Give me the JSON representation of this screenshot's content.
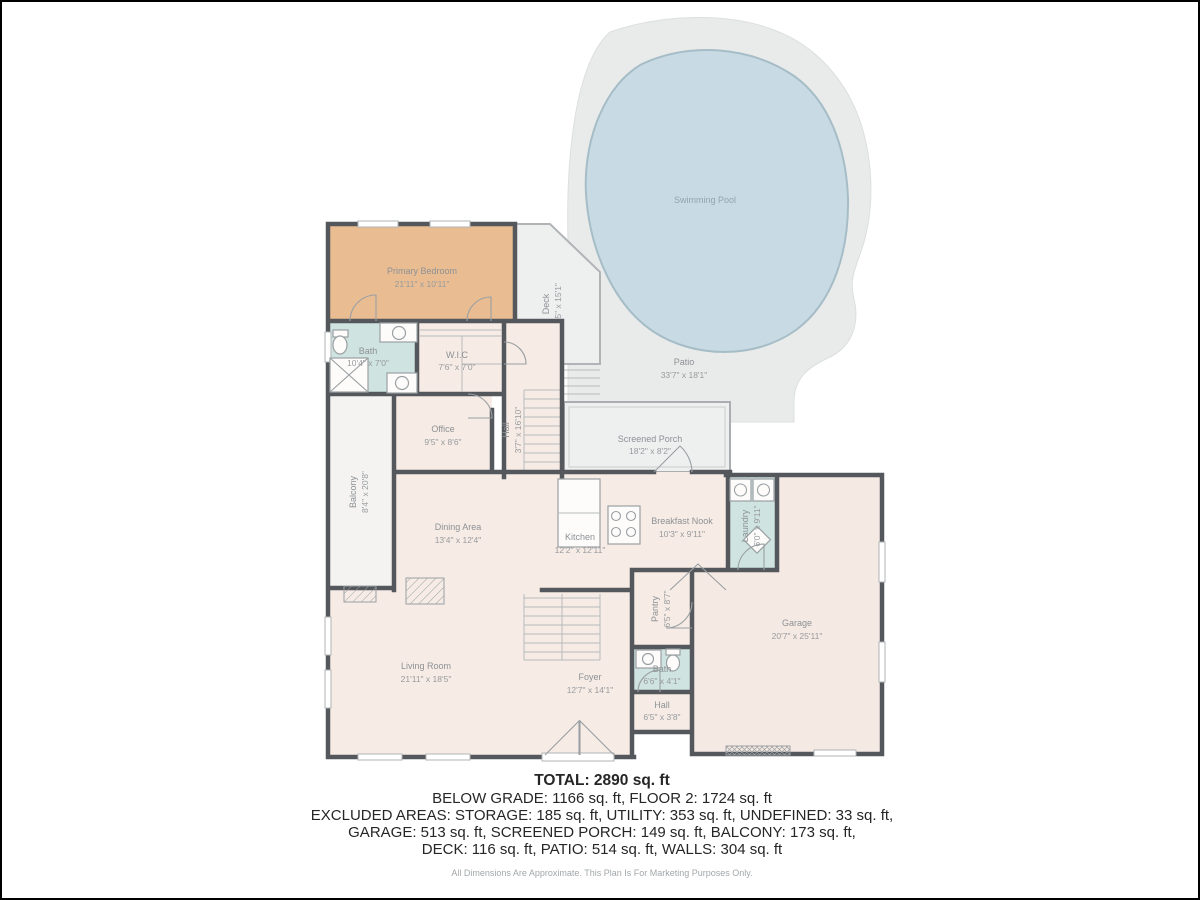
{
  "rooms": {
    "primary_bedroom": {
      "name": "Primary Bedroom",
      "dims": "21'11\" x 10'11\""
    },
    "bath_upper": {
      "name": "Bath",
      "dims": "10'4\" x 7'0\""
    },
    "wic": {
      "name": "W.I.C",
      "dims": "7'6\" x 7'0\""
    },
    "hall_upper": {
      "name": "Hall",
      "dims": "3'7\" x 16'10\""
    },
    "office": {
      "name": "Office",
      "dims": "9'5\" x 8'6\""
    },
    "balcony": {
      "name": "Balcony",
      "dims": "8'4\" x 20'8\""
    },
    "deck": {
      "name": "Deck",
      "dims": "7'5\" x 15'1\""
    },
    "patio": {
      "name": "Patio",
      "dims": "33'7\" x 18'1\""
    },
    "pool": {
      "name": "Swimming Pool"
    },
    "screened_porch": {
      "name": "Screened Porch",
      "dims": "18'2\" x 8'2\""
    },
    "dining": {
      "name": "Dining Area",
      "dims": "13'4\" x 12'4\""
    },
    "kitchen": {
      "name": "Kitchen",
      "dims": "12'2\" x 12'11\""
    },
    "breakfast_nook": {
      "name": "Breakfast Nook",
      "dims": "10'3\" x 9'11\""
    },
    "laundry": {
      "name": "Laundry",
      "dims": "6'0\" x 9'11\""
    },
    "pantry": {
      "name": "Pantry",
      "dims": "6'5\" x 8'7\""
    },
    "bath_main": {
      "name": "Bath",
      "dims": "6'6\" x 4'1\""
    },
    "hall_main": {
      "name": "Hall",
      "dims": "6'5\" x 3'8\""
    },
    "foyer": {
      "name": "Foyer",
      "dims": "12'7\" x 14'1\""
    },
    "living": {
      "name": "Living Room",
      "dims": "21'11\" x 18'5\""
    },
    "garage": {
      "name": "Garage",
      "dims": "20'7\" x 25'11\""
    }
  },
  "summary": {
    "total": "TOTAL: 2890 sq. ft",
    "lines": [
      "BELOW GRADE: 1166 sq. ft, FLOOR 2: 1724 sq. ft",
      "EXCLUDED AREAS: STORAGE: 185 sq. ft, UTILITY: 353 sq. ft, UNDEFINED: 33 sq. ft,",
      "GARAGE: 513 sq. ft, SCREENED PORCH: 149 sq. ft, BALCONY: 173 sq. ft,",
      "DECK: 116 sq. ft, PATIO: 514 sq. ft, WALLS: 304 sq. ft"
    ],
    "disclaimer": "All Dimensions Are Approximate. This Plan Is For Marketing Purposes Only."
  },
  "colors": {
    "wall": "#54585c",
    "room_fill": "#f6ebe5",
    "bedroom_fill": "#e9bc92",
    "wet_room_fill": "#cfe3e0",
    "outdoor_fill": "#edefef",
    "patio_fill": "#e9ebea",
    "pool_fill": "#c8dbe4",
    "label_text": "#8d9195"
  }
}
